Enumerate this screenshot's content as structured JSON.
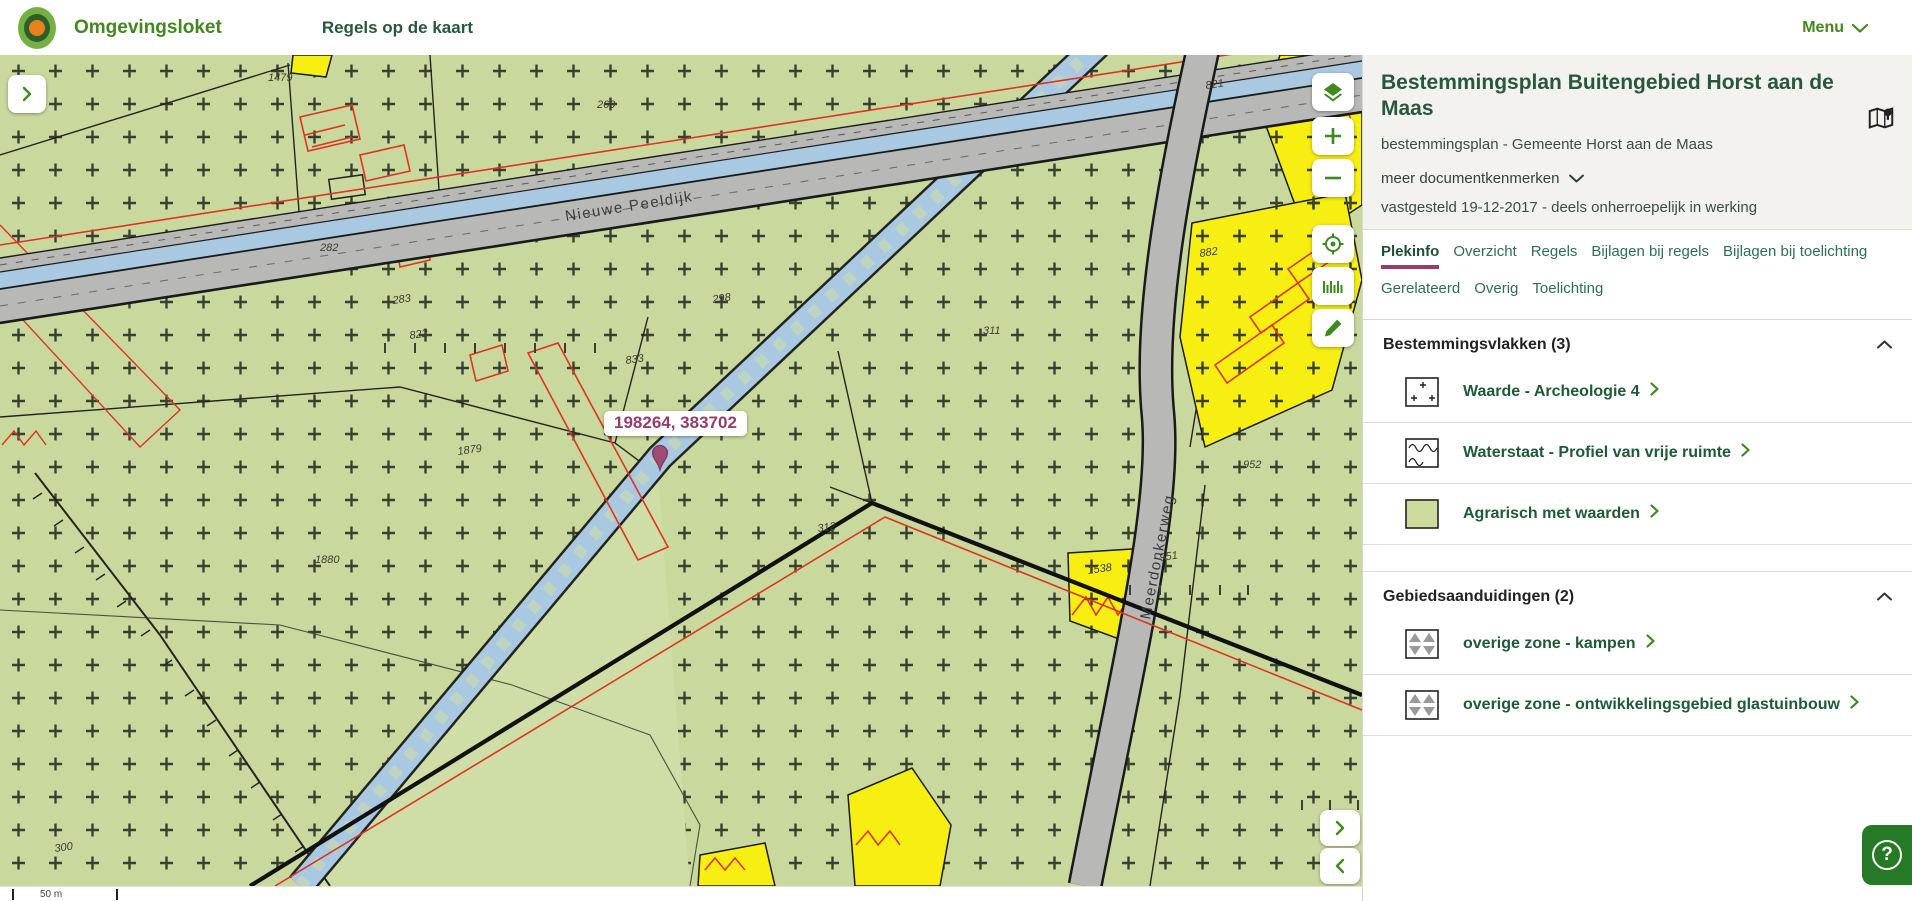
{
  "header": {
    "brand": "Omgevingsloket",
    "nav_item": "Regels op de kaart",
    "menu_label": "Menu"
  },
  "panel": {
    "title": "Bestemmingsplan Buitengebied Horst aan de Maas",
    "subtitle": "bestemmingsplan - Gemeente Horst aan de Maas",
    "more_link": "meer documentkenmerken",
    "status": "vastgesteld 19-12-2017 - deels onherroepelijk in werking",
    "tabs": [
      {
        "label": "Plekinfo",
        "active": true
      },
      {
        "label": "Overzicht",
        "active": false
      },
      {
        "label": "Regels",
        "active": false
      },
      {
        "label": "Bijlagen bij regels",
        "active": false
      },
      {
        "label": "Bijlagen bij toelichting",
        "active": false
      },
      {
        "label": "Gerelateerd",
        "active": false
      },
      {
        "label": "Overig",
        "active": false
      },
      {
        "label": "Toelichting",
        "active": false
      }
    ],
    "sections": [
      {
        "title": "Bestemmingsvlakken (3)",
        "items": [
          {
            "label": "Waarde - Archeologie 4",
            "icon": "archeology-pattern"
          },
          {
            "label": "Waterstaat - Profiel van vrije ruimte",
            "icon": "waves-pattern"
          },
          {
            "label": "Agrarisch met waarden",
            "icon": "green-fill"
          }
        ]
      },
      {
        "title": "Gebiedsaanduidingen (2)",
        "items": [
          {
            "label": "overige zone - kampen",
            "icon": "triangles-pattern"
          },
          {
            "label": "overige zone - ontwikkelingsgebied glastuinbouw",
            "icon": "triangles-pattern"
          }
        ]
      }
    ]
  },
  "map": {
    "tooltip": "198264, 383702",
    "scale_label": "50 m",
    "streets": [
      {
        "text": "Nieuwe Peeldijk",
        "x": 566,
        "y": 166,
        "rot": -9
      },
      {
        "text": "Meerdonkerweg",
        "x": 1150,
        "y": 565,
        "rot": -79
      }
    ],
    "parcels": [
      {
        "text": "1479",
        "x": 268,
        "y": 26,
        "rot": 0
      },
      {
        "text": "269",
        "x": 597,
        "y": 53,
        "rot": 0
      },
      {
        "text": "821",
        "x": 1206,
        "y": 34,
        "rot": -8
      },
      {
        "text": "282",
        "x": 320,
        "y": 196,
        "rot": 0
      },
      {
        "text": "283",
        "x": 393,
        "y": 249,
        "rot": -8
      },
      {
        "text": "298",
        "x": 713,
        "y": 248,
        "rot": -8
      },
      {
        "text": "822",
        "x": 410,
        "y": 284,
        "rot": -8
      },
      {
        "text": "833",
        "x": 626,
        "y": 309,
        "rot": -8
      },
      {
        "text": "311",
        "x": 983,
        "y": 279,
        "rot": 0
      },
      {
        "text": "882",
        "x": 1200,
        "y": 202,
        "rot": -8
      },
      {
        "text": "952",
        "x": 1243,
        "y": 413,
        "rot": 0
      },
      {
        "text": "312",
        "x": 818,
        "y": 477,
        "rot": -8
      },
      {
        "text": "951",
        "x": 1160,
        "y": 506,
        "rot": -8
      },
      {
        "text": "1538",
        "x": 1088,
        "y": 519,
        "rot": -8
      },
      {
        "text": "1879",
        "x": 458,
        "y": 400,
        "rot": -8
      },
      {
        "text": "1880",
        "x": 315,
        "y": 508,
        "rot": 0
      },
      {
        "text": "300",
        "x": 55,
        "y": 797,
        "rot": -8
      }
    ]
  },
  "colors": {
    "brand_green": "#44871d",
    "dark_green": "#27583b",
    "tab_teal": "#2d6e56",
    "accent_maroon": "#963d6b",
    "ui_green": "#3e8a1f",
    "help_green": "#267a26",
    "map_base": "#cfdda6",
    "map_hatch_area": "#c9d89d",
    "map_yellow": "#f7ee12",
    "map_water_blue": "#a9c8e1",
    "map_road_gray": "#b8b8b6",
    "map_red": "#e0331f"
  }
}
